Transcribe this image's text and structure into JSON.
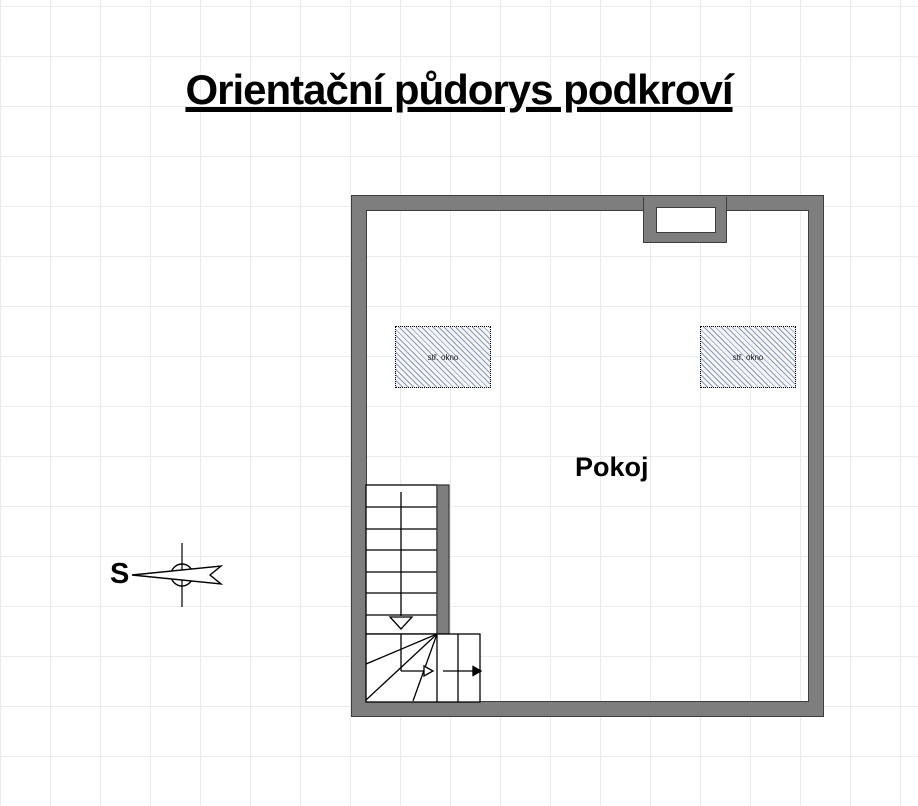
{
  "title": "Orientační půdorys podkroví",
  "room_label": "Pokoj",
  "compass_label": "S",
  "windows": [
    {
      "label": "stř. okno"
    },
    {
      "label": "stř. okno"
    }
  ],
  "colors": {
    "background": "#ffffff",
    "grid_line": "#ebebeb",
    "wall_fill": "#7e7e7e",
    "wall_edge": "#3d3d3d",
    "hatch_line": "#8f9ab3",
    "hatch_bg": "#f3f6fa",
    "line": "#000000",
    "text": "#000000"
  }
}
